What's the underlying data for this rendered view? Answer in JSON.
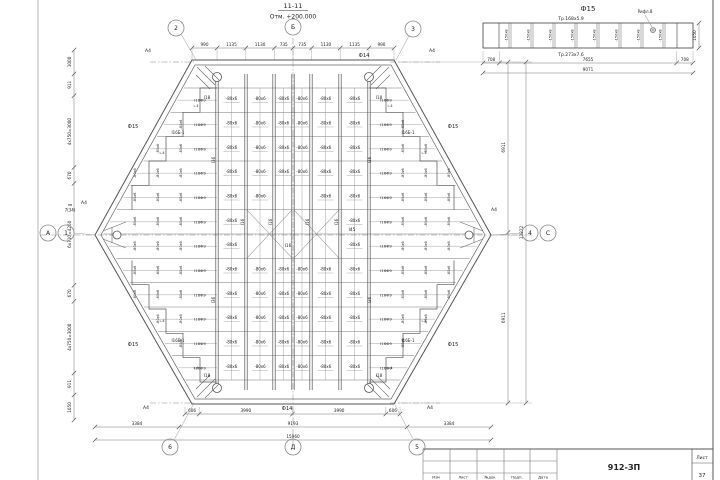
{
  "drawing": {
    "section_title": "11-11",
    "elevation_note": "Отм. +200.000",
    "axes": {
      "top_left": "2",
      "top_center": "Б",
      "top_right": "3",
      "left_letter": "А",
      "left_number": "1",
      "right_number": "4",
      "right_letter": "С",
      "bottom_left": "6",
      "bottom_center": "Д",
      "bottom_right": "5"
    },
    "corner_plate_label": "А4",
    "side_note": {
      "line1": "пв",
      "line2": "7(34)"
    },
    "edge_beams": {
      "top": "Ф14",
      "bottom": "Ф14",
      "diagonal": "Ф15"
    },
    "beam_marks": {
      "web_plate": "-80х6",
      "runner": "I16",
      "center_girder": "I45",
      "edge_post": "I36",
      "wedge_row": "I16Ф9",
      "corner_step": "I18",
      "corner_beam": "I16Б-1",
      "angle": "∟4"
    },
    "dims": {
      "top": [
        "990",
        "1135",
        "1130",
        "735",
        "735",
        "1130",
        "1135",
        "990"
      ],
      "left": [
        "1000",
        "911",
        "4х750=3000",
        "670",
        "6х710=4260",
        "670",
        "4х750=3000",
        "911",
        "1050"
      ],
      "right": [
        "6911",
        "6911"
      ],
      "right_total": "13822",
      "bottom_row1": [
        "606",
        "3990",
        "3990",
        "606"
      ],
      "bottom_row2": [
        "3384",
        "9193",
        "3384"
      ],
      "bottom_total": "15960"
    }
  },
  "detail": {
    "title": "Ф15",
    "top_chord": "Тр.168х5.9",
    "bottom_chord": "Тр.273х7.6",
    "stiffener": "-150х8",
    "note": "Рифл.8",
    "dims": [
      "708",
      "7655",
      "708"
    ],
    "total": "9071",
    "height": "1050"
  },
  "title_block": {
    "code": "912-ЗП",
    "sheet_label": "Лист",
    "sheet_number": "37",
    "columns": [
      "Изм",
      "Лист",
      "№док",
      "Подп.",
      "Дата"
    ]
  }
}
